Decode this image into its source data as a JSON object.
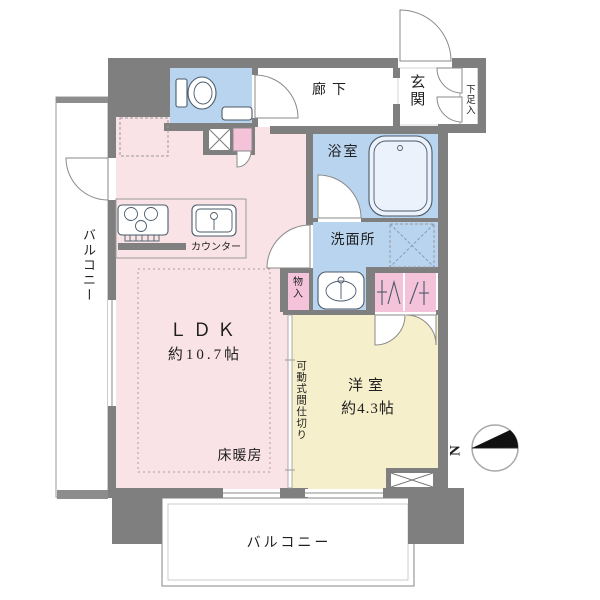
{
  "floorplan": {
    "rooms": {
      "ldk": {
        "label": "ＬＤＫ",
        "size": "約10.7帖"
      },
      "western": {
        "label": "洋室",
        "size": "約4.3帖"
      },
      "hallway": "廊下",
      "entrance": "玄関",
      "shoe_cabinet": "下足入",
      "bathroom": "浴室",
      "washroom": "洗面所",
      "storage": "物入",
      "balcony_left": "バルコニー",
      "balcony_bottom": "バルコニー"
    },
    "annotations": {
      "floor_heating": "床暖房",
      "counter": "カウンター",
      "movable_partition": "可動式間仕切り",
      "compass_north": "N"
    },
    "colors": {
      "bg": "#ffffff",
      "wall": "#7f7f7f",
      "ldk_pink": "#f9e3e7",
      "room_yellow": "#f6efcb",
      "wet_blue": "#b9d4ef",
      "accent_pink": "#f4c3da",
      "tub_fill": "#ebf2fb",
      "line_gray": "#999999",
      "fixture_stroke": "#4a5a6a",
      "text": "#1f1f1f"
    }
  }
}
